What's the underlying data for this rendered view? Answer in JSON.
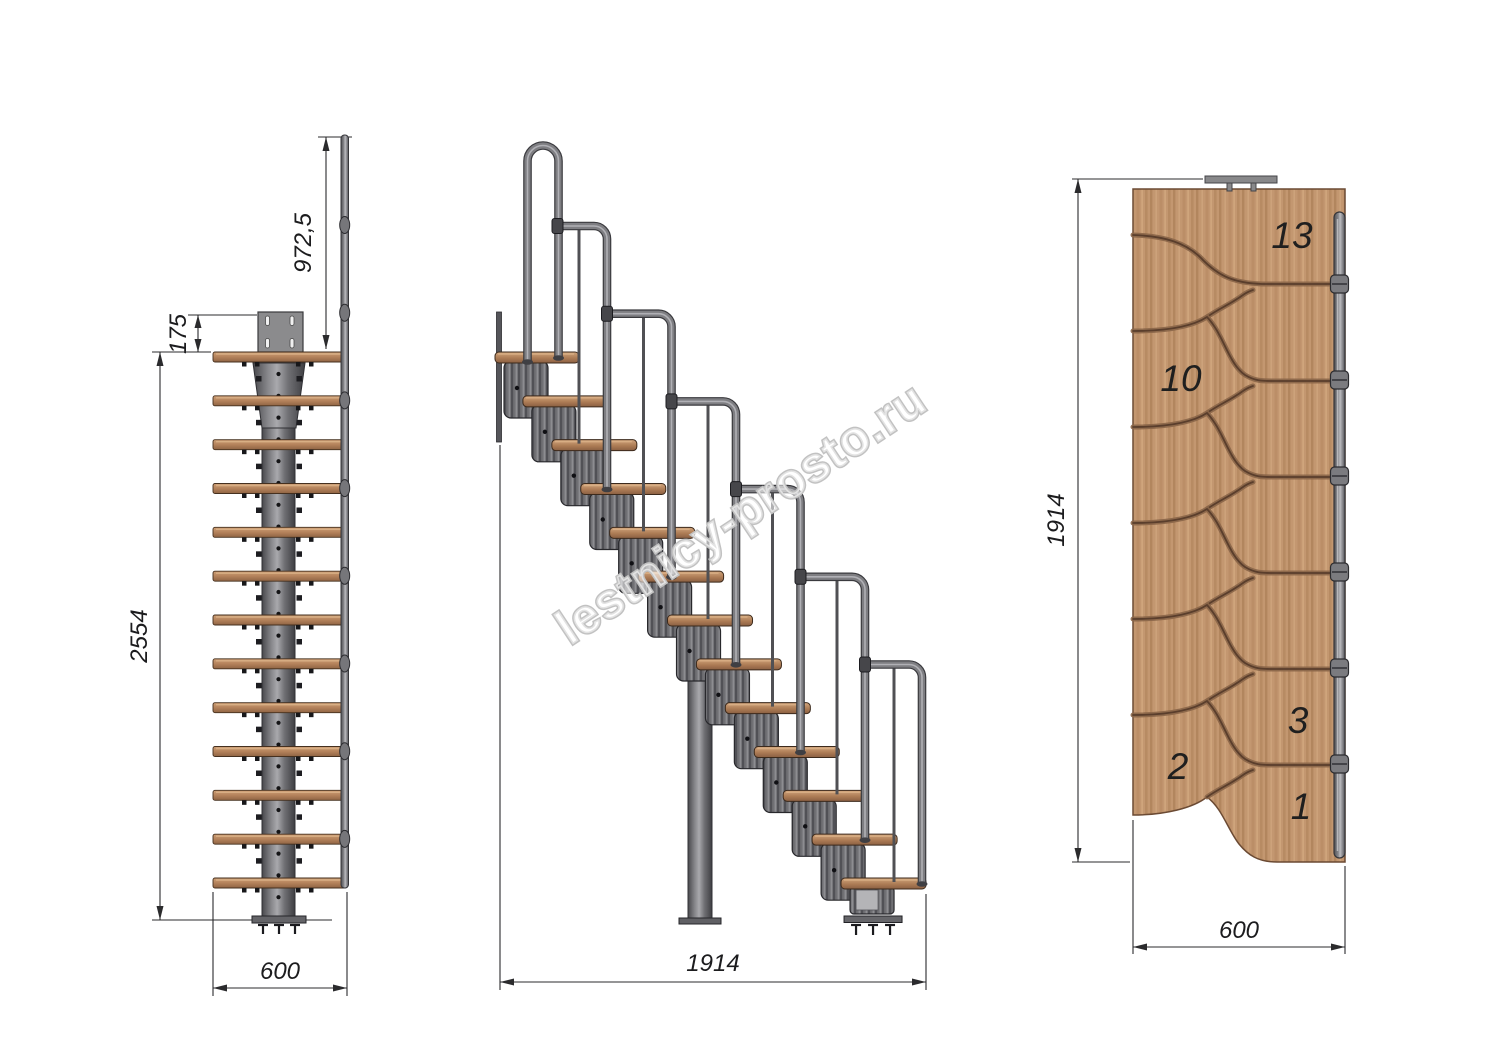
{
  "watermark": "lestnicy-prosto.ru",
  "front": {
    "dims": {
      "rail_height": "972,5",
      "plate_offset": "175",
      "total_height": "2554",
      "width": "600"
    }
  },
  "side": {
    "dims": {
      "run": "1914"
    }
  },
  "plan": {
    "dims": {
      "run": "1914",
      "width": "600"
    },
    "steps": [
      {
        "label": "13"
      },
      {
        "label": "10"
      },
      {
        "label": "3"
      },
      {
        "label": "2"
      },
      {
        "label": "1"
      }
    ]
  },
  "colors": {
    "wood_light": "#c39770",
    "wood_dark": "#8f6444",
    "metal": "#7e7e82",
    "metal_dark": "#3a3a3e",
    "dim_line": "#2b2b2d",
    "background": "#ffffff"
  }
}
